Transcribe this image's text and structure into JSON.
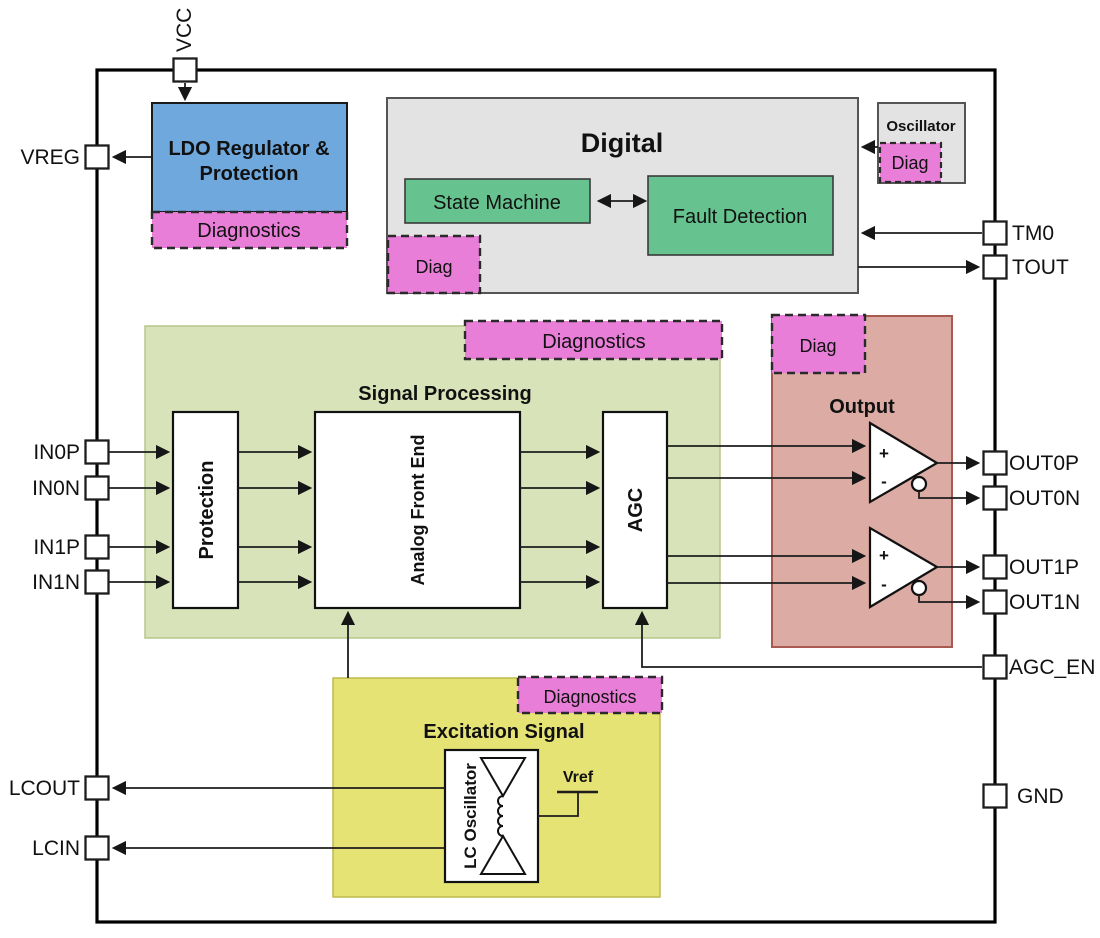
{
  "pins": {
    "vcc": "VCC",
    "vreg": "VREG",
    "in0p": "IN0P",
    "in0n": "IN0N",
    "in1p": "IN1P",
    "in1n": "IN1N",
    "lcout": "LCOUT",
    "lcin": "LCIN",
    "tm0": "TM0",
    "tout": "TOUT",
    "out0p": "OUT0P",
    "out0n": "OUT0N",
    "out1p": "OUT1P",
    "out1n": "OUT1N",
    "agc_en": "AGC_EN",
    "gnd": "GND"
  },
  "blocks": {
    "ldo_line1": "LDO Regulator &",
    "ldo_line2": "Protection",
    "ldo_diag": "Diagnostics",
    "digital": "Digital",
    "state_machine": "State Machine",
    "fault_detection": "Fault Detection",
    "digital_diag": "Diag",
    "oscillator": "Oscillator",
    "oscillator_diag": "Diag",
    "signal_processing": "Signal Processing",
    "sp_diag": "Diagnostics",
    "protection": "Protection",
    "afe": "Analog Front End",
    "agc": "AGC",
    "output": "Output",
    "output_diag": "Diag",
    "excitation": "Excitation Signal",
    "excitation_diag": "Diagnostics",
    "lc_oscillator": "LC Oscillator",
    "vref": "Vref"
  },
  "opamp": {
    "plus": "+",
    "minus": "-"
  },
  "colors": {
    "blue": "#6fa8dc",
    "magenta": "#e87ed8",
    "gray": "#e3e3e3",
    "green": "#66c28e",
    "signal_green": "#d9e3ba",
    "output_red": "#dcaba4",
    "excitation_yellow": "#e6e375"
  }
}
